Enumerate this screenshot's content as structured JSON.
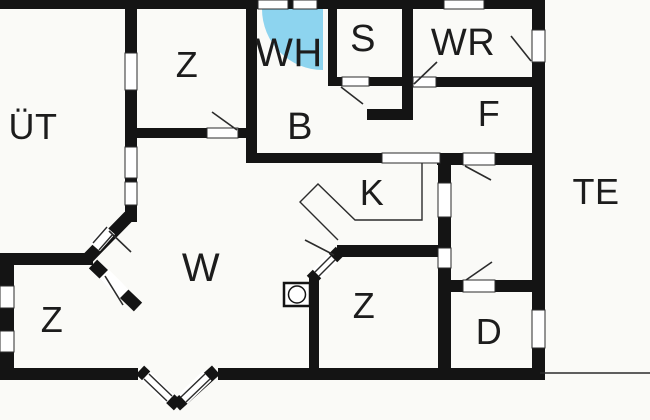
{
  "meta": {
    "type": "floor-plan",
    "description": "House floor plan with covered terrace (ÜT), terrace (TE), bedrooms (Z), living room (W), kitchen (K), bath (B) with whirlpool (WH), sauna (S), utility room (WR), hall (F), and small rooms (D)"
  },
  "colors": {
    "background": "#fafaf7",
    "wall": "#141414",
    "water": "#8dd4ef",
    "line": "#2b2b2b",
    "text": "#1c1c1c"
  },
  "rooms": [
    {
      "id": "uet",
      "label": "ÜT",
      "x": 33,
      "y": 139,
      "size": 36
    },
    {
      "id": "z-top",
      "label": "Z",
      "x": 187,
      "y": 77,
      "size": 36
    },
    {
      "id": "wh",
      "label": "WH",
      "x": 289,
      "y": 66,
      "size": 40
    },
    {
      "id": "s",
      "label": "S",
      "x": 363,
      "y": 51,
      "size": 38
    },
    {
      "id": "wr",
      "label": "WR",
      "x": 463,
      "y": 55,
      "size": 38
    },
    {
      "id": "f",
      "label": "F",
      "x": 489,
      "y": 126,
      "size": 36
    },
    {
      "id": "b",
      "label": "B",
      "x": 300,
      "y": 139,
      "size": 38
    },
    {
      "id": "k",
      "label": "K",
      "x": 372,
      "y": 205,
      "size": 36
    },
    {
      "id": "te",
      "label": "TE",
      "x": 596,
      "y": 204,
      "size": 36
    },
    {
      "id": "w",
      "label": "W",
      "x": 201,
      "y": 281,
      "size": 40
    },
    {
      "id": "z-bottom-left",
      "label": "Z",
      "x": 52,
      "y": 332,
      "size": 36
    },
    {
      "id": "z-bottom-center",
      "label": "Z",
      "x": 364,
      "y": 318,
      "size": 36
    },
    {
      "id": "d",
      "label": "D",
      "x": 489,
      "y": 344,
      "size": 36
    }
  ],
  "fixtures": [
    {
      "id": "whirlpool-tub",
      "name": "corner whirlpool tub"
    },
    {
      "id": "stove",
      "name": "wood stove / fireplace"
    },
    {
      "id": "kitchen-counter",
      "name": "kitchen counter outline"
    }
  ]
}
